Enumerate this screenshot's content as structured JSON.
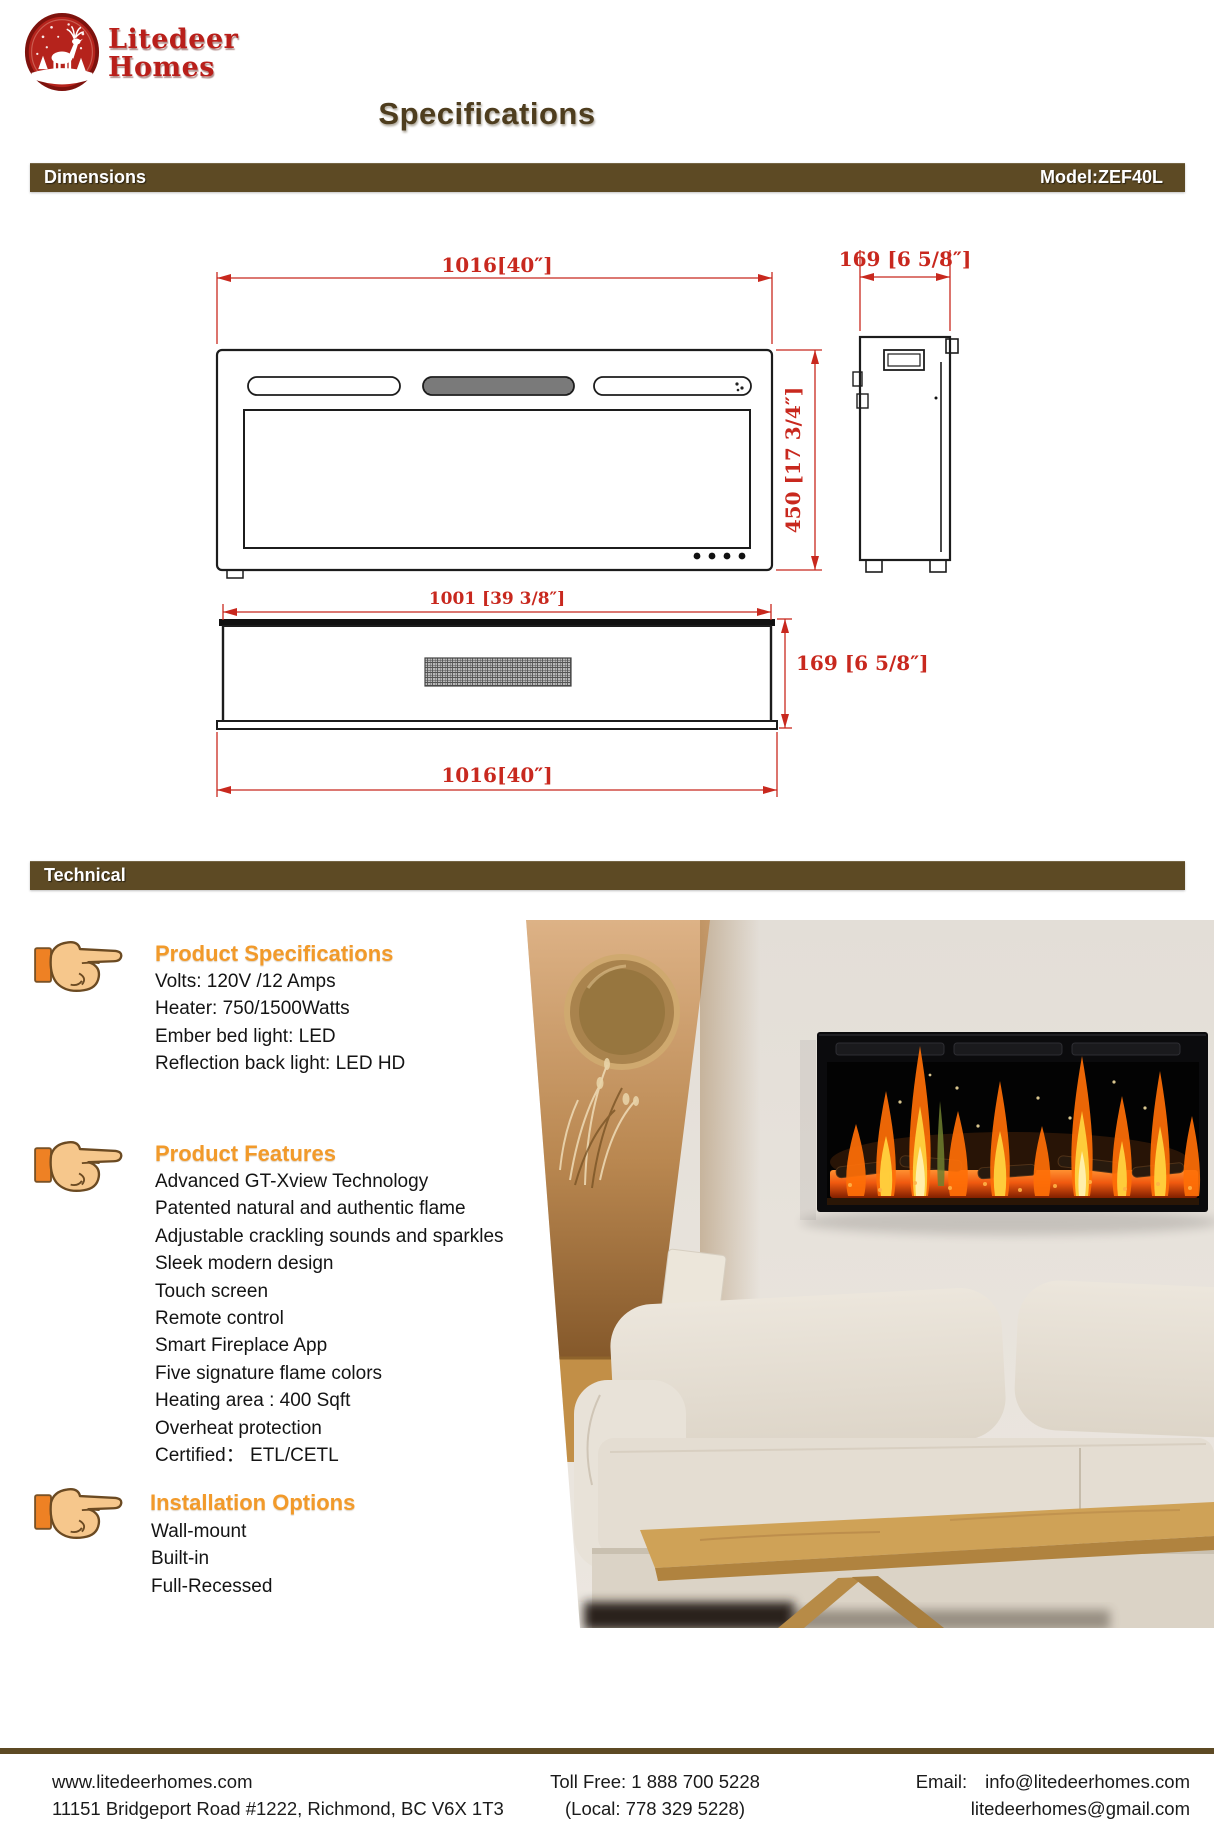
{
  "logo": {
    "name_line1": "Litedeer",
    "name_line2": "Homes"
  },
  "header": {
    "title": "Specifications"
  },
  "bars": {
    "dimensions": "Dimensions",
    "model": "Model:ZEF40L",
    "technical": "Technical"
  },
  "drawing": {
    "front_width": "1016[40″]",
    "side_depth_top": "169 [6 5/8″]",
    "front_height": "450 [17 3/4″]",
    "top_inner_width": "1001 [39 3/8″]",
    "top_depth": "169 [6 5/8″]",
    "overall_width_bottom": "1016[40″]"
  },
  "sections": [
    {
      "heading": "Product Specifications",
      "lines": [
        "Volts: 120V /12 Amps",
        "Heater: 750/1500Watts",
        "Ember bed light: LED",
        "Reflection back light: LED HD"
      ]
    },
    {
      "heading": "Product Features",
      "lines": [
        "Advanced GT-Xview Technology",
        "Patented natural and authentic flame",
        "Adjustable crackling sounds and sparkles",
        "Sleek modern design",
        "Touch screen",
        "Remote control",
        "Smart  Fireplace App",
        "Five signature flame colors",
        "Heating area : 400 Sqft",
        "Overheat protection",
        "Certified： ETL/CETL"
      ]
    },
    {
      "heading": "Installation Options",
      "lines": [
        "Wall-mount",
        "Built-in",
        "Full-Recessed"
      ]
    }
  ],
  "footer": {
    "website": "www.litedeerhomes.com",
    "address": "11151 Bridgeport Road #1222, Richmond, BC V6X 1T3",
    "toll_free": "Toll Free: 1 888 700 5228",
    "local": "(Local: 778 329 5228)",
    "email_label": "Email:",
    "email1": "info@litedeerhomes.com",
    "email2": "litedeerhomes@gmail.com"
  },
  "colors": {
    "bar_brown": "#5d4a24",
    "title_brown": "#4e3d1e",
    "heading_orange": "#f29a2a",
    "dimension_red": "#c8281e",
    "logo_red": "#b91f1a"
  }
}
